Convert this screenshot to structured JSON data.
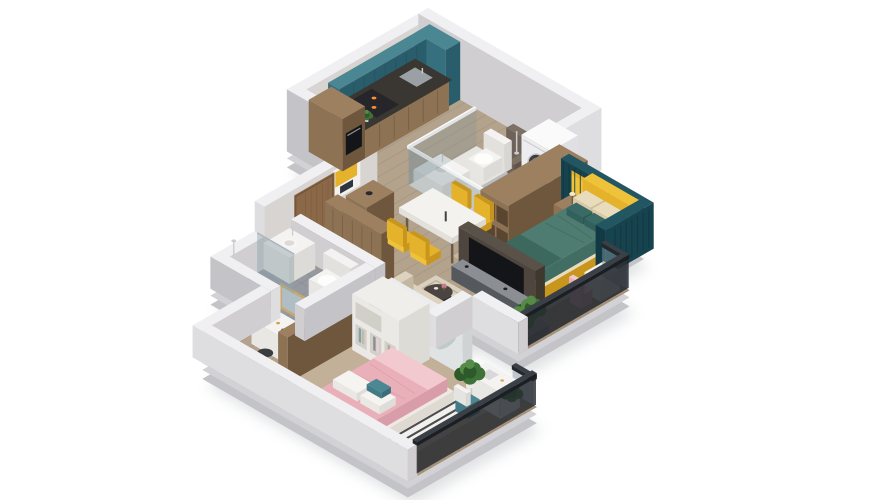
{
  "scene": {
    "description": "3D isometric cutaway rendering of a two-bedroom apartment floor plan viewed from above",
    "background": "#ffffff"
  },
  "palette": {
    "bg": "#ffffff",
    "shadow": "#9aa0a6",
    "slabDark": "#c3c3c8",
    "slabLight": "#d2d2d6",
    "wallTop": "#f0f0f2",
    "wallFaceLight": "#dedde0",
    "wallFaceMid": "#d0ced1",
    "wallFaceDark": "#c4c3c8",
    "wallInnerWarm": "#d8d4d1",
    "whiteWall": "#eceae7",
    "floorWood": "#b3a28c",
    "floorPlank": "#8e7c66",
    "floorBedroom": "#c7b59d",
    "floorBed2": "#c2b098",
    "deck": "#a5937c",
    "deckPlank": "#8a7a64",
    "bathFloor": "#e7e5e0",
    "showerTileDark": "#6f6359",
    "showerFloor": "#b9bdc0",
    "tileGray": "#969aa0",
    "tileLine": "#7e8288",
    "tileDark": "#6f7377",
    "tealCab": "#36707e",
    "tealCabDark": "#2a5d6b",
    "tealCabTop": "#4b8793",
    "counterDark": "#3a3631",
    "woodCab": "#8d7254",
    "woodCabDark": "#6e573c",
    "woodCabTop": "#9c805f",
    "woodDoor": "#8a6848",
    "accentTeal": "#17434e",
    "accentTealTop": "#235663",
    "slat": "#0d3540",
    "yellow": "#e5b22c",
    "yellowBright": "#eec33a",
    "yellowDark": "#c9961d",
    "bedding": "#4e7c71",
    "beddingDark": "#3c685e",
    "cream": "#e9dcbd",
    "white": "#f4f3f1",
    "machineWhite": "#f1f1f3",
    "sofa": "#dcd2bd",
    "sofaDark": "#c7bca4",
    "cushionTeal": "#4c8894",
    "cushionLight": "#9fb9bf",
    "rugBase": "#d9d0bd",
    "rugPattern": "#b5a88f",
    "pink": "#e9b0ba",
    "pinkLight": "#f3c9d0",
    "pinkDark": "#d99da9",
    "tan": "#c9a87e",
    "tvDark": "#141519",
    "tvPanel": "#4e463e",
    "consoleGray": "#55595e",
    "green": "#3f7239",
    "greenDark": "#2e5a2b",
    "greenLight": "#558a47",
    "glass": "#7e939b",
    "railDark": "#23282e",
    "chrome": "#c9cdd2",
    "navy": "#2e3440",
    "flame": "#ff9030",
    "mural": "#dfe3e4",
    "muralLeaf": "#b7c2c6"
  },
  "rooms": [
    {
      "name": "kitchen",
      "items": [
        "tall-cabinet",
        "upper-cabinets",
        "base-cabinets",
        "counter",
        "stove",
        "oven",
        "sink"
      ]
    },
    {
      "name": "entry",
      "items": [
        "entry-door",
        "wall-art",
        "console-cabinet",
        "plant"
      ]
    },
    {
      "name": "laundry-nook",
      "items": [
        "washing-machine",
        "plant"
      ]
    },
    {
      "name": "master-bathroom",
      "items": [
        "shower",
        "toilet",
        "sink",
        "glass-walls"
      ]
    },
    {
      "name": "master-bedroom",
      "items": [
        "double-bed",
        "yellow-headboard",
        "accent-wall",
        "nightstand",
        "wardrobe",
        "window-wall"
      ]
    },
    {
      "name": "dining-area",
      "items": [
        "dining-table",
        "yellow-chairs",
        "tableware"
      ]
    },
    {
      "name": "living-room",
      "items": [
        "tv-wall",
        "tv",
        "media-console",
        "sofa",
        "coffee-table",
        "side-table",
        "patterned-rug",
        "plant"
      ]
    },
    {
      "name": "main-balcony",
      "items": [
        "glass-railing",
        "planter",
        "plants",
        "side-table",
        "chair"
      ]
    },
    {
      "name": "hallway",
      "items": [
        "closet",
        "vanity-table",
        "mirror",
        "stool"
      ]
    },
    {
      "name": "second-bathroom",
      "items": [
        "shower",
        "toilet",
        "sink"
      ]
    },
    {
      "name": "second-bedroom",
      "items": [
        "pink-bed",
        "wardrobe",
        "desk",
        "chair",
        "striped-rug",
        "mural-wall",
        "bench",
        "plant"
      ]
    },
    {
      "name": "second-balcony",
      "items": [
        "glass-railing",
        "plant"
      ]
    }
  ]
}
